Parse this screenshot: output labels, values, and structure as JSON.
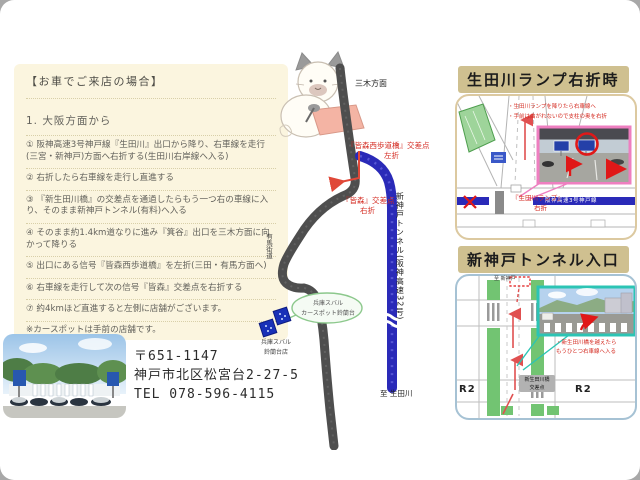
{
  "directions": {
    "title": "【お車でご来店の場合】",
    "heading": "1. 大阪方面から",
    "steps": [
      "① 阪神高速3号神戸線『生田川』出口から降り、右車線を走行(三宮・新神戸)方面へ右折する(生田川右岸線へ入る)",
      "② 右折したら右車線を走行し直進する",
      "③ 『新生田川橋』の交差点を通過したらもう一つ右の車線に入り、そのまま新神戸トンネル(有料)へ入る",
      "④ そのまま約1.4km道なりに進み『箕谷』出口を三木方面に向かって降りる",
      "⑤ 出口にある信号『皆森西歩道橋』を左折(三田・有馬方面へ)",
      "⑥ 右車線を走行して次の信号『皆森』交差点を右折する",
      "⑦ 約4kmほど直進すると左側に店舗がございます。"
    ],
    "note": "※カースポットは手前の店舗です。"
  },
  "address": {
    "postal": "〒651-1147",
    "street": "神戸市北区松宮台2-27-5",
    "tel": "TEL 078-596-4115"
  },
  "center_map": {
    "miki_label": "三木方面",
    "arima_label": "有馬街道",
    "crossing1": "『皆森西歩道橋』交差点",
    "action1": "左折",
    "crossing2": "『皆森』交差点",
    "action2": "右折",
    "tunnel_label": "新神戸トンネル(阪神高速32号)",
    "south_label": "至 生田川",
    "shop_bubble_line1": "兵庫スバル",
    "shop_bubble_line2": "カースポット鈴蘭台",
    "shop_line1": "兵庫スバル",
    "shop_line2": "鈴蘭台店"
  },
  "ikutagawa_section": {
    "title": "生田川ランプ右折時",
    "note1": "・生田川ランプを降りたら右車線へ",
    "note2": "・手前は曲がれないので支柱の奥を右折",
    "highway_label": "阪神高速3号神戸線",
    "ramp_label": "『生田川ランプ』",
    "turn_action": "右折"
  },
  "tunnel_section": {
    "title": "新神戸トンネル入口",
    "top_label": "至 新神戸",
    "note_line1": "・新生田川橋を越えたら",
    "note_line2": "もうひとつ右車線へ入る",
    "crossing_line1": "新生田川橋",
    "crossing_line2": "交差点",
    "route_label_left": "R2",
    "route_label_right": "R2"
  },
  "colors": {
    "red": "#d42a20",
    "blue-road": "#2a2ab8",
    "dark-road": "#4e4e4e",
    "green-road": "#72c472",
    "cream": "#fbf5df",
    "tan": "#cfc090",
    "box1-border": "#dcc9a0",
    "box2-border": "#a6c2d4",
    "teal": "#2cc4b4",
    "pink": "#ee7fc0"
  }
}
